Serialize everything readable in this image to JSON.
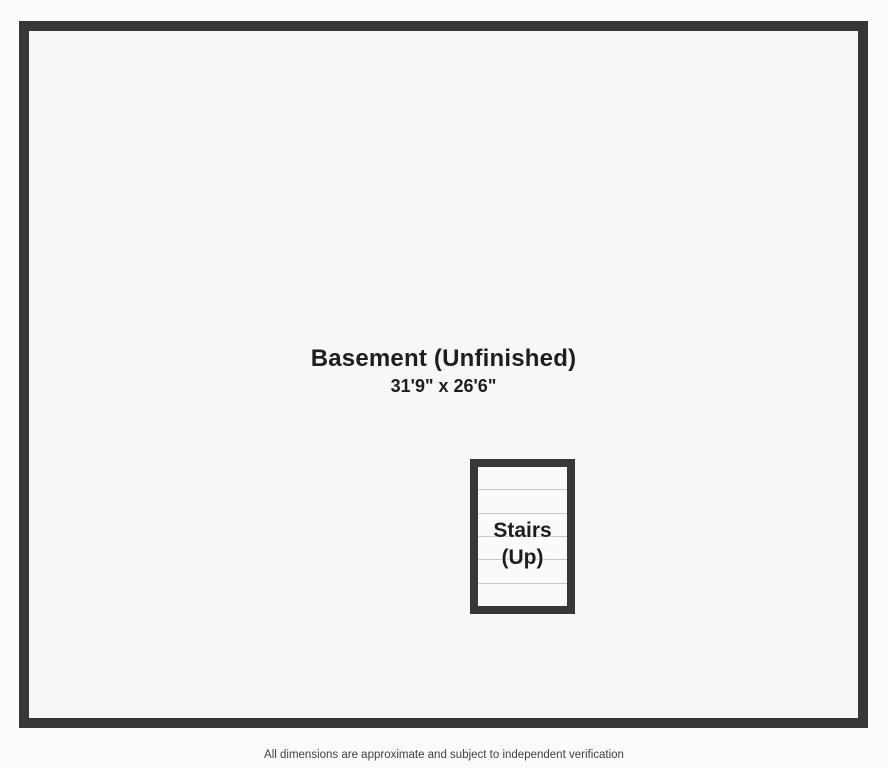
{
  "floorplan": {
    "room": {
      "name": "Basement (Unfinished)",
      "dimensions": "31'9\" x 26'6\""
    },
    "stairs": {
      "label_line1": "Stairs",
      "label_line2": "(Up)",
      "tread_count": 6
    }
  },
  "footer": {
    "disclaimer": "All dimensions are approximate and subject to independent verification"
  },
  "colors": {
    "wall": "#373737",
    "floor": "#f7f7f6",
    "stairs_floor": "#fafaf9",
    "page_background": "#fcfcfc",
    "tread_line": "#c7c7c7",
    "label_text": "#1e1e1e",
    "footer_text": "#3f3f3f"
  }
}
